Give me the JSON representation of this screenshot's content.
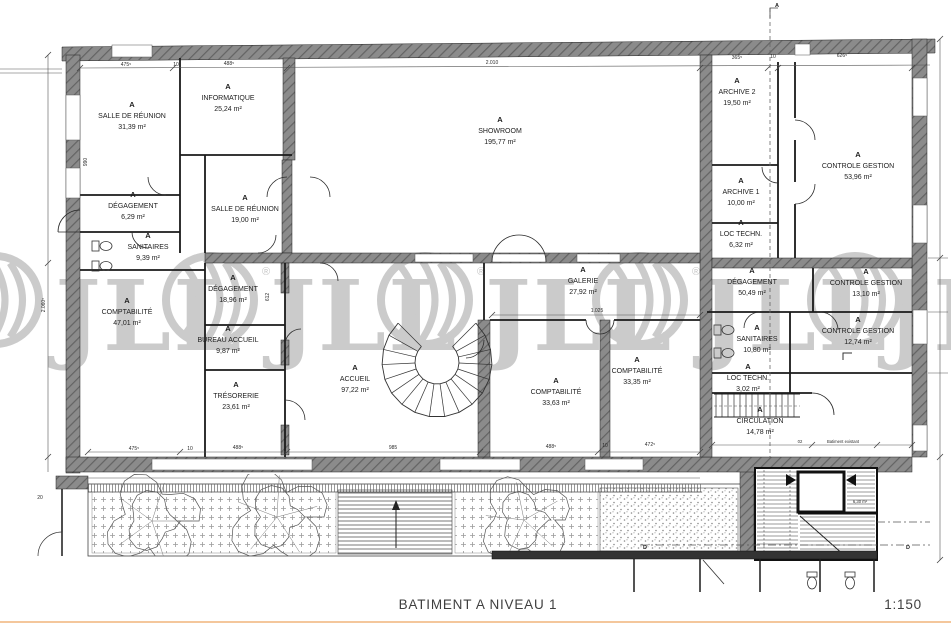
{
  "title_block": {
    "title": "BATIMENT A NIVEAU 1",
    "scale": "1:150"
  },
  "watermark": {
    "letters": "JLL",
    "registered": "®"
  },
  "markers": {
    "section_a": "A",
    "section_d": "D"
  },
  "rooms": [
    {
      "zone": "A",
      "name": "SALLE DE RÉUNION",
      "area": "31,39 m²"
    },
    {
      "zone": "A",
      "name": "INFORMATIQUE",
      "area": "25,24 m²"
    },
    {
      "zone": "A",
      "name": "SHOWROOM",
      "area": "195,77 m²"
    },
    {
      "zone": "A",
      "name": "ARCHIVE 2",
      "area": "19,50 m²"
    },
    {
      "zone": "A",
      "name": "CONTROLE GESTION",
      "area": "53,96 m²"
    },
    {
      "zone": "A",
      "name": "DÉGAGEMENT",
      "area": "6,29 m²"
    },
    {
      "zone": "A",
      "name": "SALLE DE RÉUNION",
      "area": "19,00 m²"
    },
    {
      "zone": "A",
      "name": "ARCHIVE 1",
      "area": "10,00 m²"
    },
    {
      "zone": "A",
      "name": "SANITAIRES",
      "area": "9,39 m²"
    },
    {
      "zone": "A",
      "name": "LOC TECHN.",
      "area": "6,32 m²"
    },
    {
      "zone": "A",
      "name": "DÉGAGEMENT",
      "area": "18,96 m²"
    },
    {
      "zone": "A",
      "name": "GALERIE",
      "area": "27,92 m²"
    },
    {
      "zone": "A",
      "name": "DÉGAGEMENT",
      "area": "50,49 m²"
    },
    {
      "zone": "A",
      "name": "CONTROLE GESTION",
      "area": "13,10 m²"
    },
    {
      "zone": "A",
      "name": "COMPTABILITÉ",
      "area": "47,01 m²"
    },
    {
      "zone": "A",
      "name": "BUREAU ACCUEIL",
      "area": "9,87 m²"
    },
    {
      "zone": "A",
      "name": "SANITAIRES",
      "area": "10,80 m²"
    },
    {
      "zone": "A",
      "name": "CONTROLE GESTION",
      "area": "12,74 m²"
    },
    {
      "zone": "A",
      "name": "TRÉSORERIE",
      "area": "23,61 m²"
    },
    {
      "zone": "A",
      "name": "ACCUEIL",
      "area": "97,22 m²"
    },
    {
      "zone": "A",
      "name": "COMPTABILITÉ",
      "area": "33,63 m²"
    },
    {
      "zone": "A",
      "name": "COMPTABILITÉ",
      "area": "33,35 m²"
    },
    {
      "zone": "A",
      "name": "LOC TECHN.",
      "area": "3,02 m²"
    },
    {
      "zone": "A",
      "name": "CIRCULATION",
      "area": "14,78 m²"
    }
  ],
  "dimensions": {
    "top": [
      "475⁵",
      "10",
      "488⁵",
      "2.010",
      "365⁵",
      "10",
      "626⁵"
    ],
    "bottom": [
      "475⁵",
      "10",
      "488⁵",
      "985",
      "488⁵",
      "10",
      "472⁵"
    ],
    "left_height": "2.060⁵",
    "galerie_width": "1.025",
    "terrace_offset": "20",
    "wall_a": "990",
    "wall_b": "612",
    "stair_area": "6,30 m²",
    "existing_num": "02",
    "existing_label": "Batiment existant"
  },
  "colors": {
    "wall": "#8b8b8b",
    "wall_hatch": "#636363",
    "line": "#1d1d1d",
    "watermark": "#cbcbcb",
    "footer_rule": "#f4c79c"
  }
}
